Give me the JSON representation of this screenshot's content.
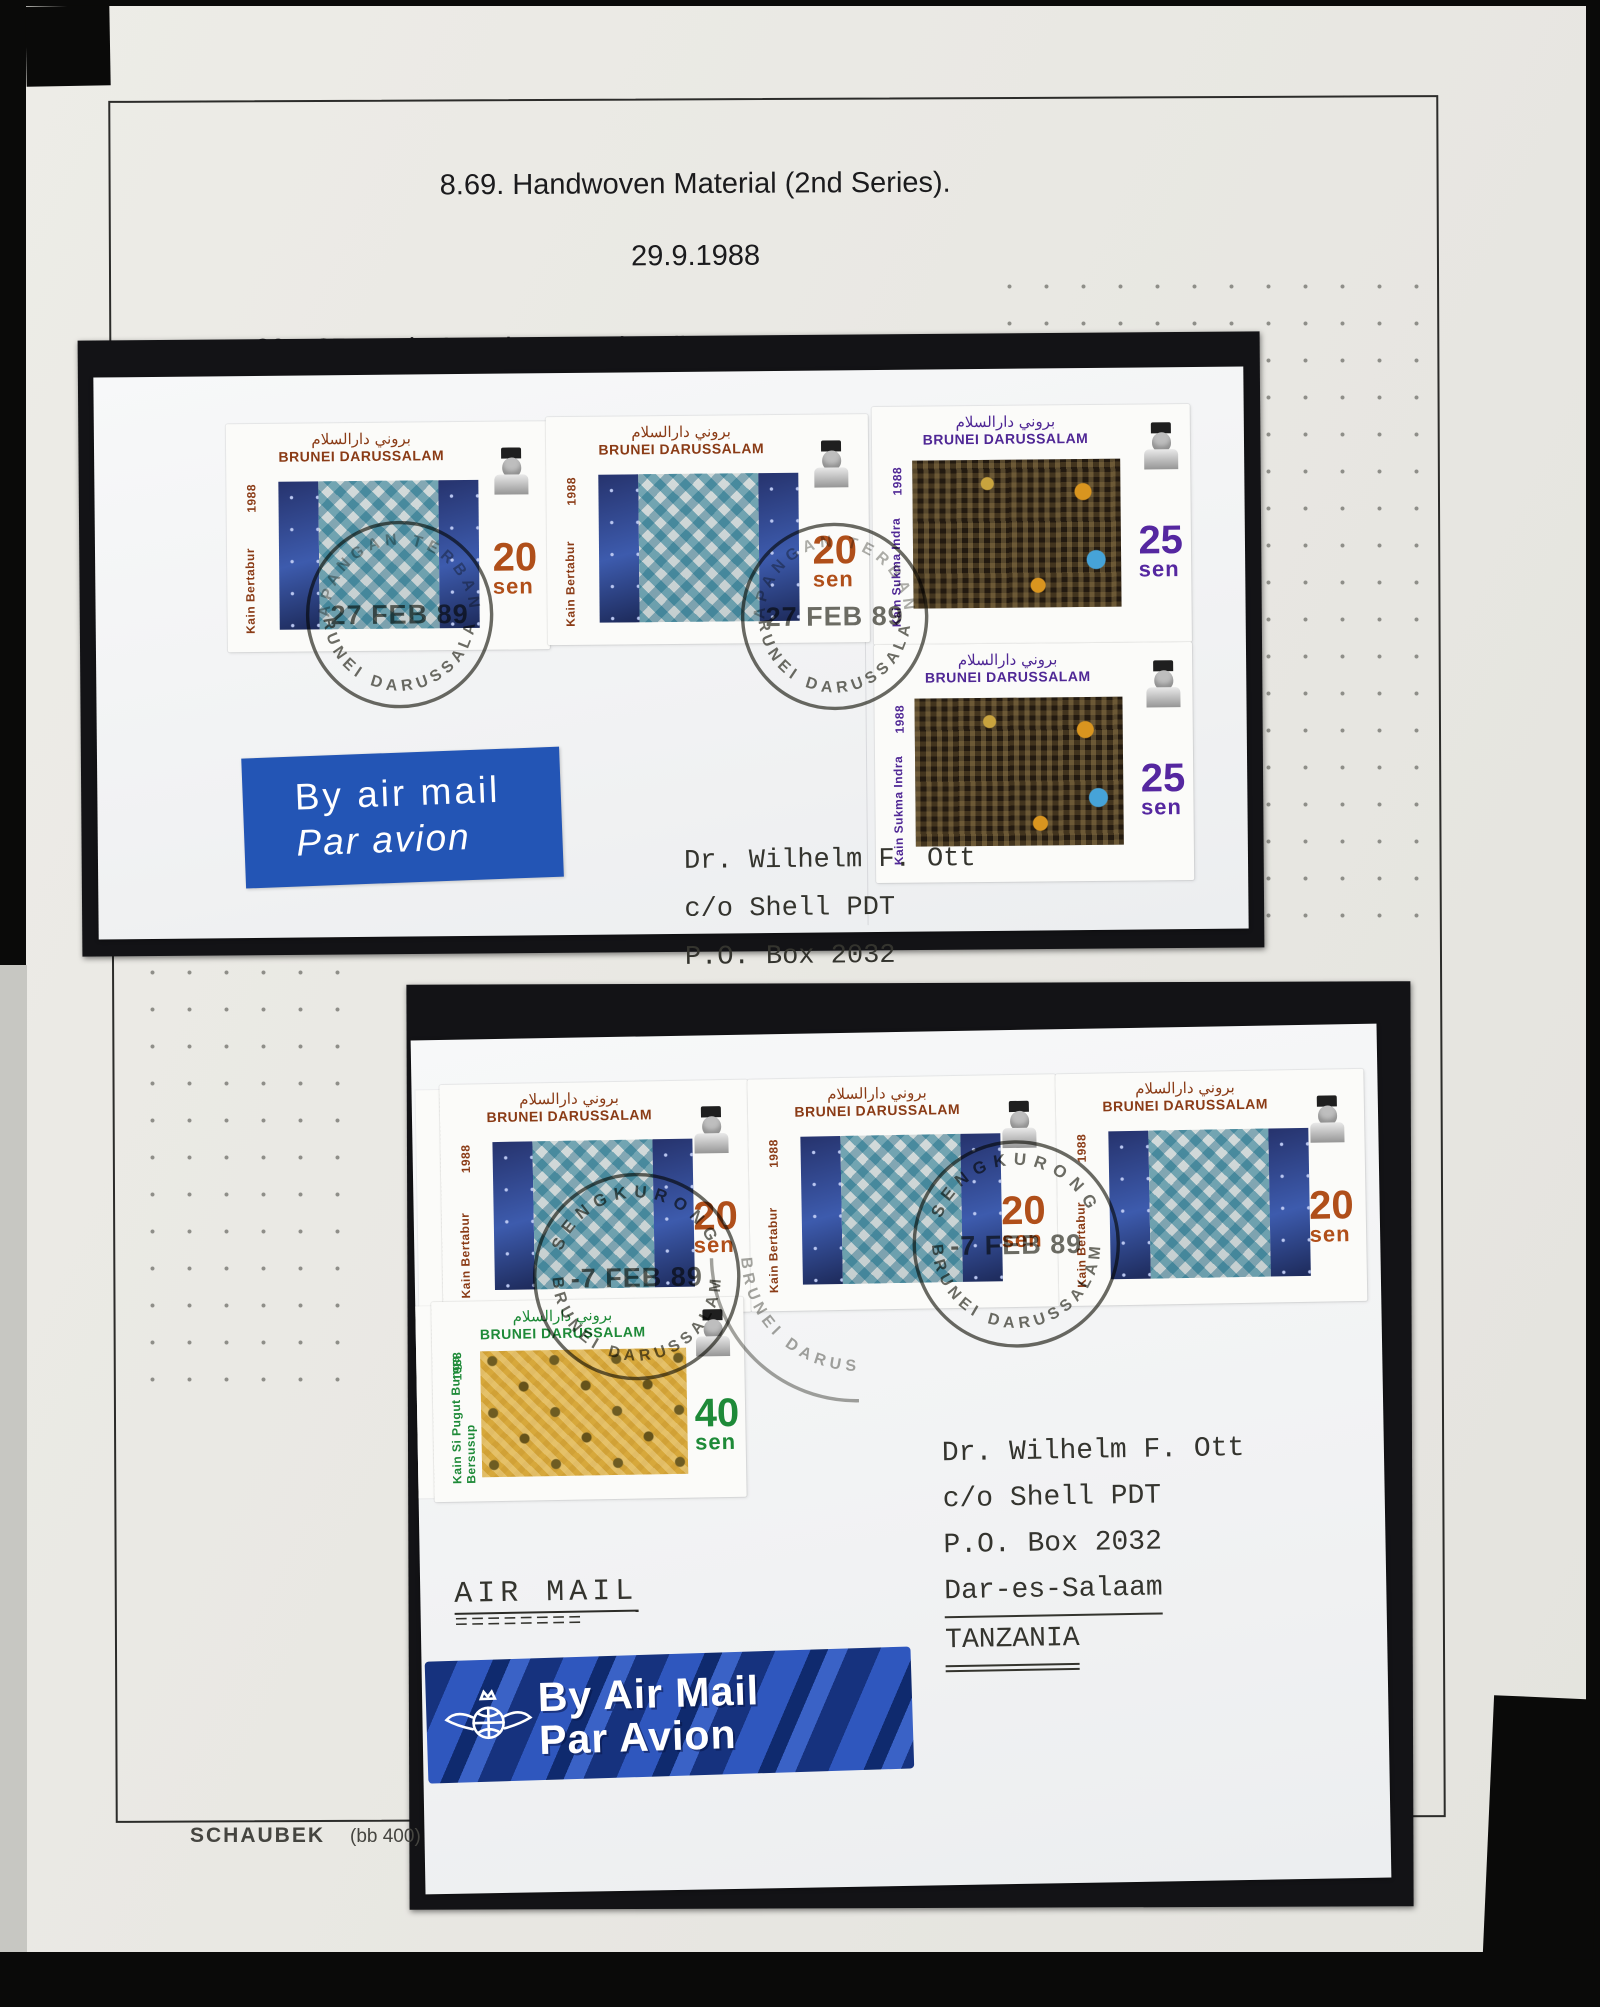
{
  "header": {
    "line1": "8.69. Handwoven Material (2nd Series).",
    "line2": "29.9.1988",
    "line3": "20s, 25s and 40s values on airmail covers from the International Airport",
    "line4": "(Lapangan Terbang, 27 FEB 89)  and  Sengkurong (7 FEB 89), both  to",
    "line5": "Dar-es-Salaam, Tanzania."
  },
  "stamps": {
    "country_latin": "BRUNEI DARUSSALAM",
    "country_arabic": "بروني دارالسلام",
    "year": "1988",
    "s20": {
      "name": "Kain Bertabur",
      "value": "20",
      "unit": "sen"
    },
    "s25": {
      "name": "Kain Sukma Indra",
      "value": "25",
      "unit": "sen"
    },
    "s40": {
      "name": "Kain Si Pugut Bunga Bersusup",
      "name_line1": "Kain Si Pugut Bunga",
      "name_line2": "Bersusup",
      "value": "40",
      "unit": "sen"
    }
  },
  "cover_top": {
    "postmark": {
      "top": "LAPANGAN TERBANG",
      "date": "27 FEB 89",
      "bottom": "BRUNEI DARUSSALAM"
    },
    "label": {
      "line1": "By air mail",
      "line2": "Par avion"
    },
    "address": [
      "Dr. Wilhelm F. Ott",
      "c/o Shell PDT",
      "P.O. Box 2032"
    ]
  },
  "cover_bottom": {
    "postmark": {
      "top": "SENGKURONG",
      "date": "-7 FEB 89",
      "bottom": "BRUNEI DARUSSALAM"
    },
    "note": "AIR MAIL",
    "note_underline": "========",
    "label": {
      "line1": "By Air Mail",
      "line2": "Par Avion"
    },
    "address": [
      "Dr. Wilhelm F. Ott",
      "c/o Shell PDT",
      "P.O. Box 2032",
      "Dar-es-Salaam",
      "TANZANIA"
    ]
  },
  "footer": {
    "brand": "SCHAUBEK",
    "ref": "(bb 400)"
  },
  "colors": {
    "stamp_20_text": "#8a3b16",
    "stamp_20_value": "#b04f1a",
    "stamp_25_text": "#4f2795",
    "stamp_25_value": "#5527a0",
    "stamp_40_text": "#1e8a38",
    "airmail_label_top": "#2355b5",
    "airmail_label_bottom_stripes": "#16327e",
    "postmark_ink": "#4a4a42",
    "page_background": "#e9e8e3",
    "mount_black": "#131316"
  }
}
